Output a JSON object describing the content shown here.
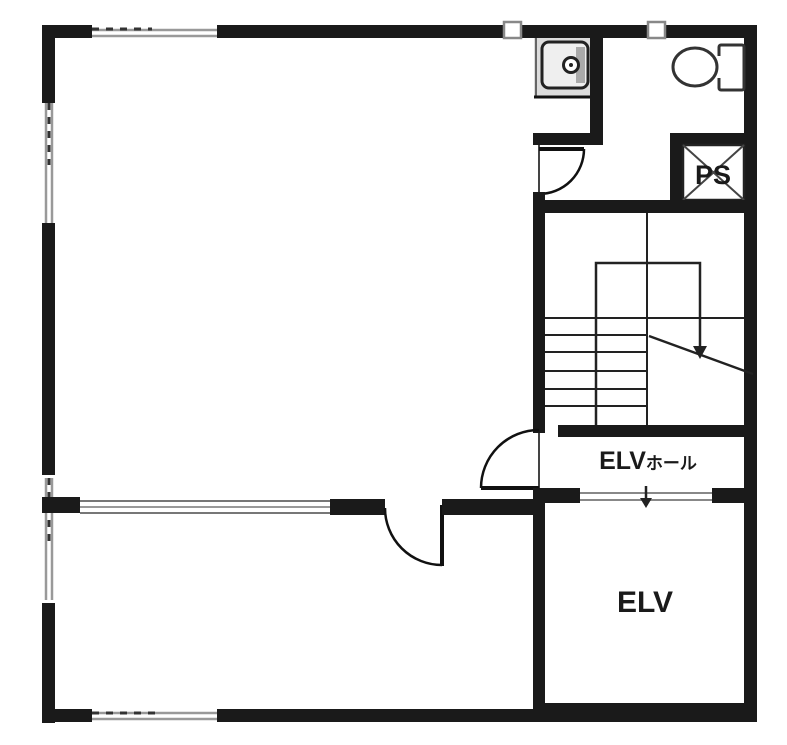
{
  "page": {
    "kind": "architectural-floor-plan"
  },
  "labels": {
    "elv_hall_main": "ELV",
    "elv_hall_suffix": "ホール",
    "elevator": "ELV",
    "pipe_space": "PS"
  },
  "icons": {
    "toilet": "toilet-icon",
    "sink": "sink-icon",
    "stair_direction_arrow": "stair-direction-arrow-icon",
    "elevator_door_marker": "elevator-door-arrow-icon",
    "wall_vent_markers": "wall-vent-icon"
  },
  "colors": {
    "wall": "#1a1a1a",
    "window_line": "#999999",
    "counter_fill": "#dddddd",
    "background": "#ffffff"
  }
}
